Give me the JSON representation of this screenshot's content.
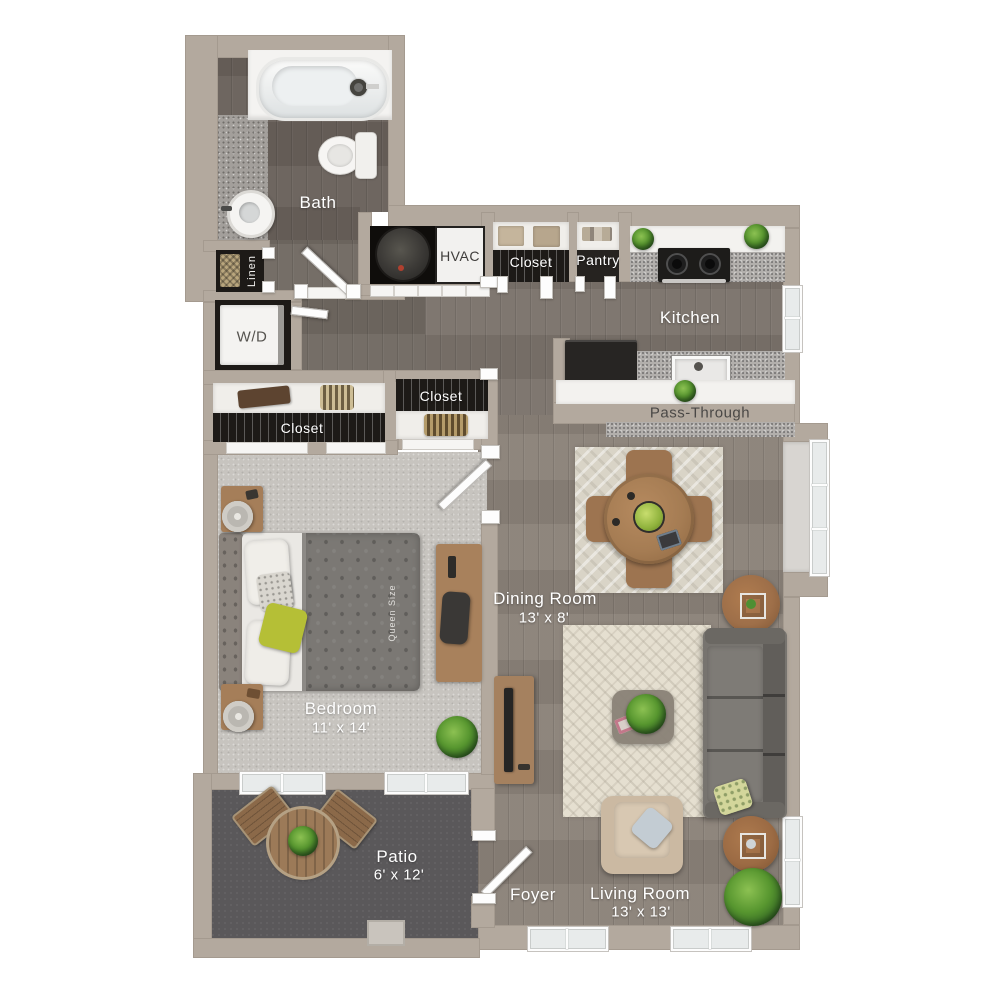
{
  "plan": {
    "title": "One bedroom apartment floor plan",
    "rooms": {
      "bath": {
        "label": "Bath"
      },
      "linen": {
        "label": "Linen"
      },
      "laundry": {
        "label": "W/D"
      },
      "hvac": {
        "label": "HVAC"
      },
      "kitchen_closet": {
        "label": "Closet"
      },
      "pantry": {
        "label": "Pantry"
      },
      "kitchen": {
        "label": "Kitchen"
      },
      "pass_through": {
        "label": "Pass-Through"
      },
      "bedroom_closet_long": {
        "label": "Closet"
      },
      "bedroom_closet_right": {
        "label": "Closet"
      },
      "bedroom": {
        "label": "Bedroom",
        "dims": "11' x 14'"
      },
      "dining_room": {
        "label": "Dining Room",
        "dims": "13' x 8'"
      },
      "living_room": {
        "label": "Living Room",
        "dims": "13' x 13'"
      },
      "foyer": {
        "label": "Foyer"
      },
      "patio": {
        "label": "Patio",
        "dims": "6' x 12'"
      }
    },
    "furniture": {
      "bed_size_label": "Queen Size"
    },
    "colors": {
      "wall": "#b3a99e",
      "wood_bath": "#69615b",
      "wood_hall": "#716962",
      "wood_kitchen": "#7b736b",
      "wood_main": "#8b8279",
      "carpet": "#c7c4bf",
      "patio_floor": "#5a585a",
      "room_label_text": "#ffffff",
      "dark_label_text": "#4a4846",
      "accent_plant": "#57962f"
    }
  }
}
